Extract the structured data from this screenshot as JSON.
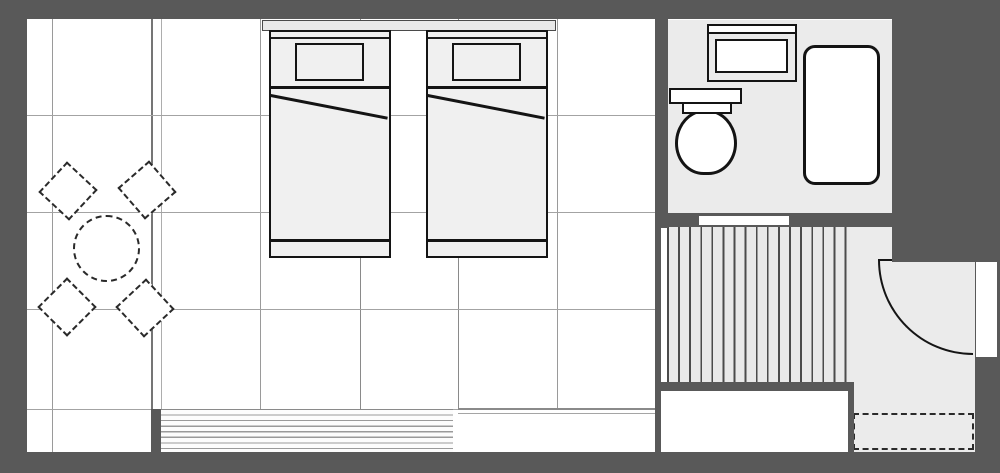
{
  "title": "guest-room-floor-plan",
  "colors": {
    "wall": "#595959",
    "floor": "#ffffff",
    "room": "#ebebeb",
    "furniture": "#f0f0f0",
    "outline": "#141414",
    "grid": "#9a9a9a",
    "grid_dark": "#757575",
    "stripe": "#4b4b4b",
    "stripebg": "#e9e9e9",
    "louver": "#9a9a9a",
    "sill": "#8a8a8a",
    "dash": "#2a2a2a",
    "headboard": "#e9e9e9"
  },
  "rooms": [
    {
      "id": "main-room",
      "furniture": [
        "headboard-panel",
        "bed-1",
        "bed-2",
        "round-table",
        "chair-top-left",
        "chair-top-right",
        "chair-bottom-left",
        "chair-bottom-right",
        "louver-window",
        "window-counter"
      ]
    },
    {
      "id": "bathroom",
      "furniture": [
        "vanity-sink",
        "toilet",
        "bathtub"
      ],
      "openings": [
        "bathroom-door-opening"
      ]
    },
    {
      "id": "hallway",
      "furniture": [
        "striped-flooring",
        "closet"
      ]
    },
    {
      "id": "entry",
      "furniture": [
        "entry-door-leaf",
        "entry-door-swing-arc",
        "door-mat"
      ],
      "openings": [
        "entry-door-opening"
      ]
    }
  ],
  "counts": {
    "beds": 2,
    "chairs": 4,
    "pillows": 2,
    "hall_stripe_lines": 17,
    "louver_lines": 7,
    "grid_columns": 7,
    "grid_rows": 4
  }
}
